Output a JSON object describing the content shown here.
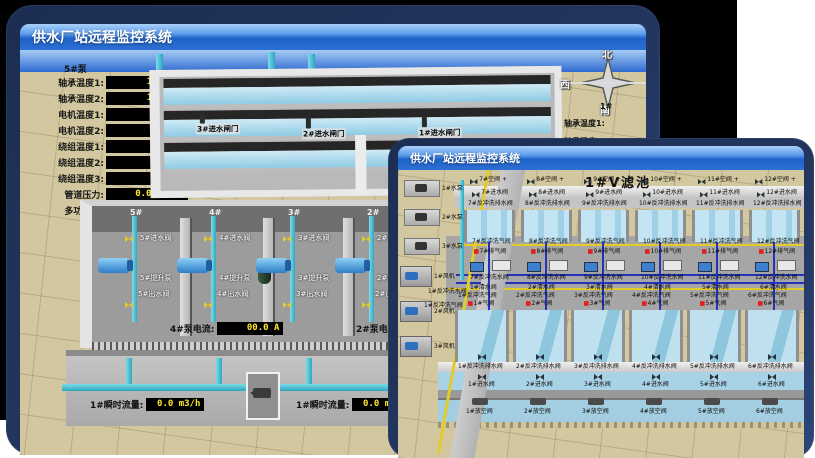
{
  "back_window": {
    "title": "供水厂站远程监控系统",
    "scene_title": "取水泵房",
    "pump_group_label": "5#泵",
    "readouts": [
      {
        "label": "轴承温度1:",
        "value": "100.0℃"
      },
      {
        "label": "轴承温度2:",
        "value": "100.0℃"
      },
      {
        "label": "电机温度1:",
        "value": "18.1℃"
      },
      {
        "label": "电机温度2:",
        "value": "17.9℃"
      },
      {
        "label": "绕组温度1:",
        "value": "18.0℃"
      },
      {
        "label": "绕组温度2:",
        "value": "18.1℃"
      },
      {
        "label": "绕组温度3:",
        "value": "18.1℃"
      },
      {
        "label": "管道压力:",
        "value": "0.0007MPa"
      },
      {
        "label": "多功能阀:",
        "value": "0%"
      }
    ],
    "gates": [
      {
        "label": "3#进水闸门"
      },
      {
        "label": "2#进水闸门"
      },
      {
        "label": "1#进水闸门"
      }
    ],
    "compass": {
      "north": "北",
      "west": "西",
      "south": "南",
      "east": "东"
    },
    "side_partial": {
      "tag": "1#",
      "line1": "轴承温度1:",
      "line2": "轴承温度2:"
    },
    "bays": [
      {
        "num": "5#",
        "inlet": "5#进水阀",
        "pump": "5#提升泵",
        "outlet": "5#出水阀"
      },
      {
        "num": "4#",
        "inlet": "4#进水阀",
        "pump": "4#提升泵",
        "outlet": "4#出水阀"
      },
      {
        "num": "3#",
        "inlet": "3#进水阀",
        "pump": "3#提升泵",
        "outlet": "3#出水阀"
      },
      {
        "num": "2#",
        "inlet": "2#进水阀",
        "pump": "2#提升泵",
        "outlet": "2#出水阀"
      }
    ],
    "current_left": {
      "label": "4#泵电流:",
      "value": "00.0 A"
    },
    "current_right": {
      "label": "2#泵电流:",
      "value": "00.0 A"
    },
    "flow_left": {
      "label": "1#瞬时流量:",
      "value": "0.0 m3/h"
    },
    "flow_right": {
      "label": "1#瞬时流量:",
      "value": "0.0 m3/h"
    }
  },
  "front_window": {
    "title": "供水厂站远程监控系统",
    "scene_title": "1#V滤池",
    "pumps": [
      {
        "label": "1#水泵"
      },
      {
        "label": "2#水泵"
      },
      {
        "label": "3#水泵"
      }
    ],
    "blowers": [
      {
        "label": "1#风机"
      },
      {
        "label": "2#风机"
      },
      {
        "label": "3#风机"
      }
    ],
    "side_labels": {
      "bw_water": "1#反冲洗水阀",
      "bw_air": "1#反冲洗气阀"
    },
    "top_cells": [
      {
        "air": "7#空阀",
        "inlet": "7#进水阀",
        "drain": "7#反冲洗排水阀",
        "bw_air": "7#反冲洗气阀",
        "exhaust": "7#排气阀",
        "bw_water": "7#反冲洗水阀"
      },
      {
        "air": "8#空阀",
        "inlet": "8#进水阀",
        "drain": "8#反冲洗排水阀",
        "bw_air": "8#反冲洗气阀",
        "exhaust": "8#排气阀",
        "bw_water": "8#反冲洗水阀"
      },
      {
        "air": "9#空阀",
        "inlet": "9#进水阀",
        "drain": "9#反冲洗排水阀",
        "bw_air": "9#反冲洗气阀",
        "exhaust": "9#排气阀",
        "bw_water": "9#反冲洗水阀"
      },
      {
        "air": "10#空阀",
        "inlet": "10#进水阀",
        "drain": "10#反冲洗排水阀",
        "bw_air": "10#反冲洗气阀",
        "exhaust": "10#排气阀",
        "bw_water": "10#反冲洗水阀"
      },
      {
        "air": "11#空阀",
        "inlet": "11#进水阀",
        "drain": "11#反冲洗排水阀",
        "bw_air": "11#反冲洗气阀",
        "exhaust": "11#排气阀",
        "bw_water": "11#反冲洗水阀"
      },
      {
        "air": "12#空阀",
        "inlet": "12#进水阀",
        "drain": "12#反冲洗排水阀",
        "bw_air": "12#反冲洗气阀",
        "exhaust": "12#排气阀",
        "bw_water": "12#反冲洗水阀"
      }
    ],
    "bottom_cells": [
      {
        "clear": "1#清水阀",
        "bw_air": "1#反冲洗气阀",
        "air": "1#气阀",
        "drain": "1#反冲洗排水阀",
        "inlet": "1#进水阀",
        "empty": "1#放空阀"
      },
      {
        "clear": "2#清水阀",
        "bw_air": "2#反冲洗气阀",
        "air": "2#气阀",
        "drain": "2#反冲洗排水阀",
        "inlet": "2#进水阀",
        "empty": "2#放空阀"
      },
      {
        "clear": "3#清水阀",
        "bw_air": "3#反冲洗气阀",
        "air": "3#气阀",
        "drain": "3#反冲洗排水阀",
        "inlet": "3#进水阀",
        "empty": "3#放空阀"
      },
      {
        "clear": "4#清水阀",
        "bw_air": "4#反冲洗气阀",
        "air": "4#气阀",
        "drain": "4#反冲洗排水阀",
        "inlet": "4#进水阀",
        "empty": "4#放空阀"
      },
      {
        "clear": "5#清水阀",
        "bw_air": "5#反冲洗气阀",
        "air": "5#气阀",
        "drain": "5#反冲洗排水阀",
        "inlet": "5#进水阀",
        "empty": "5#放空阀"
      },
      {
        "clear": "6#清水阀",
        "bw_air": "6#反冲洗气阀",
        "air": "6#气阀",
        "drain": "6#反冲洗排水阀",
        "inlet": "6#进水阀",
        "empty": "6#放空阀"
      }
    ]
  }
}
